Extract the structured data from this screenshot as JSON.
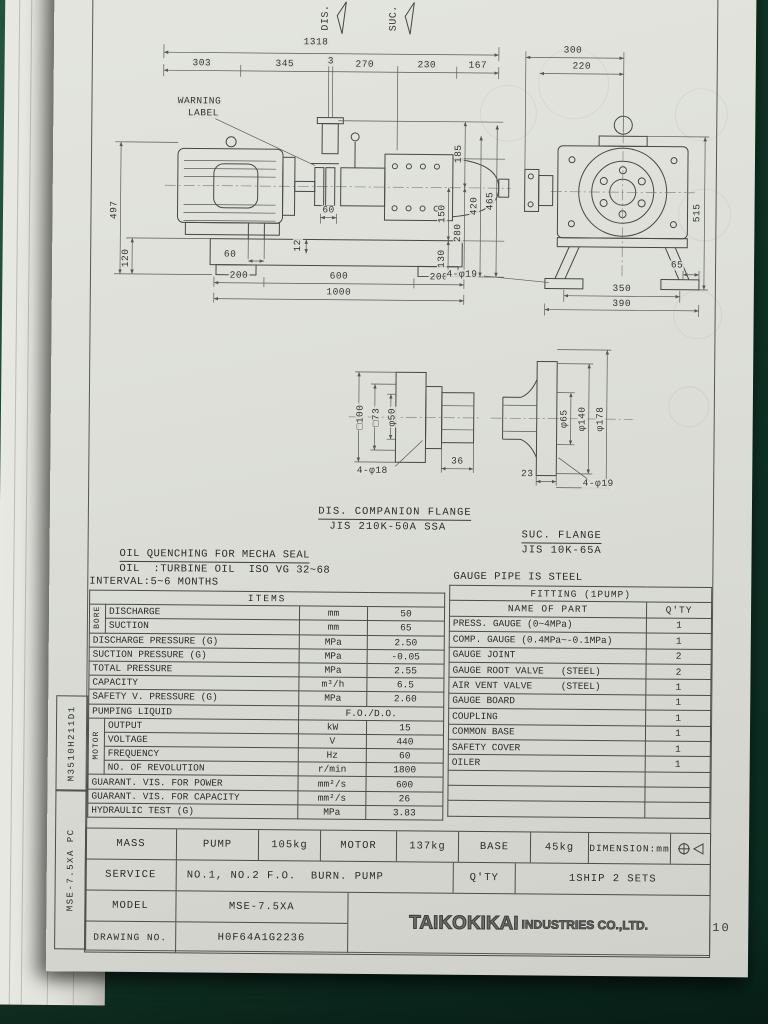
{
  "scene": {
    "page_number": "10"
  },
  "margin": {
    "upper_code": "M3510H211D1",
    "lower_code": "MSE-7.5XA PC"
  },
  "drawing": {
    "flow_labels": {
      "dis": "DIS.",
      "suc": "SUC."
    },
    "warning_line1": "WARNING",
    "warning_line2": "LABEL",
    "assembly": {
      "total": "1318",
      "seg1": "303",
      "seg2": "345",
      "seg3": "3",
      "seg4": "270",
      "seg5": "230",
      "seg6": "167",
      "height": "497",
      "base_height": "120",
      "bolt_pitch": "60",
      "foot_bolt": "60",
      "shim": "12",
      "base_left": "200",
      "base_mid": "600",
      "base_right": "200",
      "base_total": "1000",
      "h_150": "150",
      "h_130": "130",
      "h_185": "185",
      "h_280": "280",
      "h_420": "420",
      "h_465": "465"
    },
    "end_view": {
      "w1": "300",
      "w2": "220",
      "height": "515",
      "foot": "65",
      "base_inner": "350",
      "base_outer": "390",
      "holes": "4-φ19"
    },
    "dis_flange": {
      "outer": "□100",
      "pcd": "□73",
      "bore": "φ50",
      "holes": "4-φ18",
      "thickness": "36",
      "caption1": "DIS. COMPANION FLANGE",
      "caption2": "JIS 210K-50A SSA"
    },
    "suc_flange": {
      "bore": "φ65",
      "pcd": "φ140",
      "outer": "φ178",
      "thickness": "23",
      "holes": "4-φ19",
      "caption1": "SUC. FLANGE",
      "caption2": "JIS 10K-65A"
    }
  },
  "notes": {
    "line1": "OIL QUENCHING FOR MECHA SEAL",
    "line2": "OIL  :TURBINE OIL  ISO VG 32~68",
    "line3": "INTERVAL:5~6 MONTHS",
    "gauge": "GAUGE PIPE IS STEEL"
  },
  "items_table": {
    "title": "ITEMS",
    "groups": {
      "bore": "BORE",
      "motor": "MOTOR"
    },
    "rows": [
      {
        "name": "DISCHARGE",
        "unit": "mm",
        "value": "50"
      },
      {
        "name": "SUCTION",
        "unit": "mm",
        "value": "65"
      },
      {
        "name": "DISCHARGE PRESSURE (G)",
        "unit": "MPa",
        "value": "2.50"
      },
      {
        "name": "SUCTION PRESSURE (G)",
        "unit": "MPa",
        "value": "-0.05"
      },
      {
        "name": "TOTAL PRESSURE",
        "unit": "MPa",
        "value": "2.55"
      },
      {
        "name": "CAPACITY",
        "unit": "m³/h",
        "value": "6.5"
      },
      {
        "name": "SAFETY V. PRESSURE (G)",
        "unit": "MPa",
        "value": "2.60"
      },
      {
        "name": "PUMPING LIQUID",
        "value": "F.O./D.O."
      },
      {
        "name": "OUTPUT",
        "unit": "kW",
        "value": "15"
      },
      {
        "name": "VOLTAGE",
        "unit": "V",
        "value": "440"
      },
      {
        "name": "FREQUENCY",
        "unit": "Hz",
        "value": "60"
      },
      {
        "name": "NO. OF REVOLUTION",
        "unit": "r/min",
        "value": "1800"
      },
      {
        "name": "GUARANT. VIS. FOR POWER",
        "unit": "mm²/s",
        "value": "600"
      },
      {
        "name": "GUARANT. VIS. FOR CAPACITY",
        "unit": "mm²/s",
        "value": "26"
      },
      {
        "name": "HYDRAULIC TEST (G)",
        "unit": "MPa",
        "value": "3.83"
      }
    ]
  },
  "fitting_table": {
    "title": "FITTING (1PUMP)",
    "col1": "NAME OF PART",
    "col2": "Q'TY",
    "rows": [
      {
        "name": "PRESS. GAUGE (0~4MPa)",
        "qty": "1"
      },
      {
        "name": "COMP. GAUGE (0.4MPa~-0.1MPa)",
        "qty": "1"
      },
      {
        "name": "GAUGE JOINT",
        "qty": "2"
      },
      {
        "name": "GAUGE ROOT VALVE   (STEEL)",
        "qty": "2"
      },
      {
        "name": "AIR VENT VALVE     (STEEL)",
        "qty": "1"
      },
      {
        "name": "GAUGE BOARD",
        "qty": "1"
      },
      {
        "name": "COUPLING",
        "qty": "1"
      },
      {
        "name": "COMMON BASE",
        "qty": "1"
      },
      {
        "name": "SAFETY COVER",
        "qty": "1"
      },
      {
        "name": "OILER",
        "qty": "1"
      }
    ]
  },
  "title_block": {
    "mass_label": "MASS",
    "pump_label": "PUMP",
    "pump_mass": "105kg",
    "motor_label": "MOTOR",
    "motor_mass": "137kg",
    "base_label": "BASE",
    "base_mass": "45kg",
    "dimension_note": "DIMENSION:mm",
    "service_label": "SERVICE",
    "service_value": "NO.1, NO.2 F.O.  BURN. PUMP",
    "qty_label": "Q'TY",
    "qty_value": "1SHIP 2 SETS",
    "model_label": "MODEL",
    "model_value": "MSE-7.5XA",
    "drawing_no_label": "DRAWING NO.",
    "drawing_no_value": "H0F64A1G2236",
    "maker_bold": "TAIKOKIKAI",
    "maker_rest": "INDUSTRIES CO.,LTD."
  }
}
